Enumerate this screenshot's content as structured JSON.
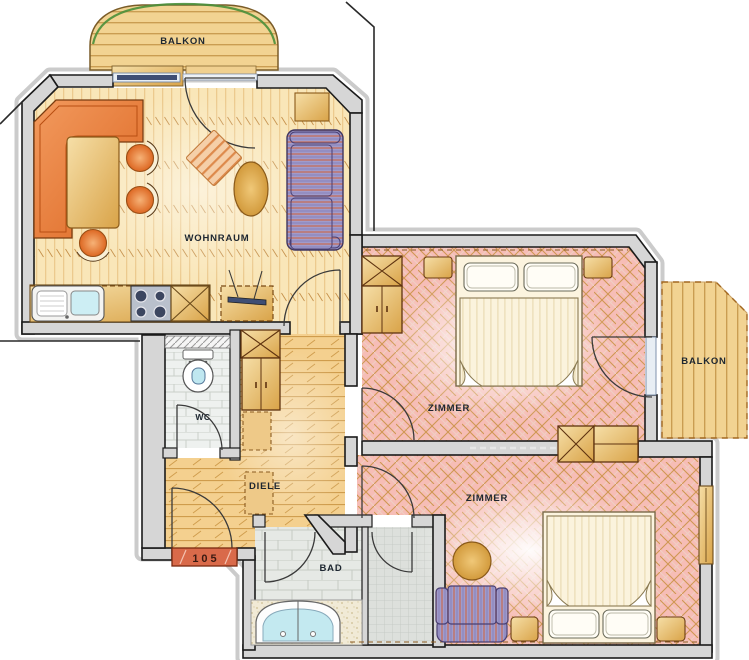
{
  "plan": {
    "title": "apartment-floor-plan",
    "rooms": [
      {
        "id": "balkon_top",
        "label": "BALKON"
      },
      {
        "id": "wohnraum",
        "label": "WOHNRAUM"
      },
      {
        "id": "wc",
        "label": "WC"
      },
      {
        "id": "diele",
        "label": "DIELE"
      },
      {
        "id": "bad",
        "label": "BAD"
      },
      {
        "id": "zimmer_1",
        "label": "ZIMMER"
      },
      {
        "id": "zimmer_2",
        "label": "ZIMMER"
      },
      {
        "id": "balkon_right",
        "label": "BALKON"
      }
    ],
    "entry": {
      "unit_number": "105"
    },
    "colors": {
      "wall": "#d6d6d6",
      "wall_outline": "#1b1b1b",
      "shadow": "#cbcbcb",
      "wood_light": "#f9e6b8",
      "diele_wood": "#f4d08f",
      "pink_floor": "#f6bdb6",
      "accent_orange": "#e8793a",
      "furniture_tan": "#e9b964",
      "sofa_blue": "#a09bcb",
      "sofa_stripe": "#c0746a",
      "water_blue": "#c3e9f0",
      "doormat_red": "#d96a4a",
      "window_glass": "#e8eef4",
      "window_bar": "#3f4e74",
      "balcony_green": "#4a8f3a"
    }
  }
}
